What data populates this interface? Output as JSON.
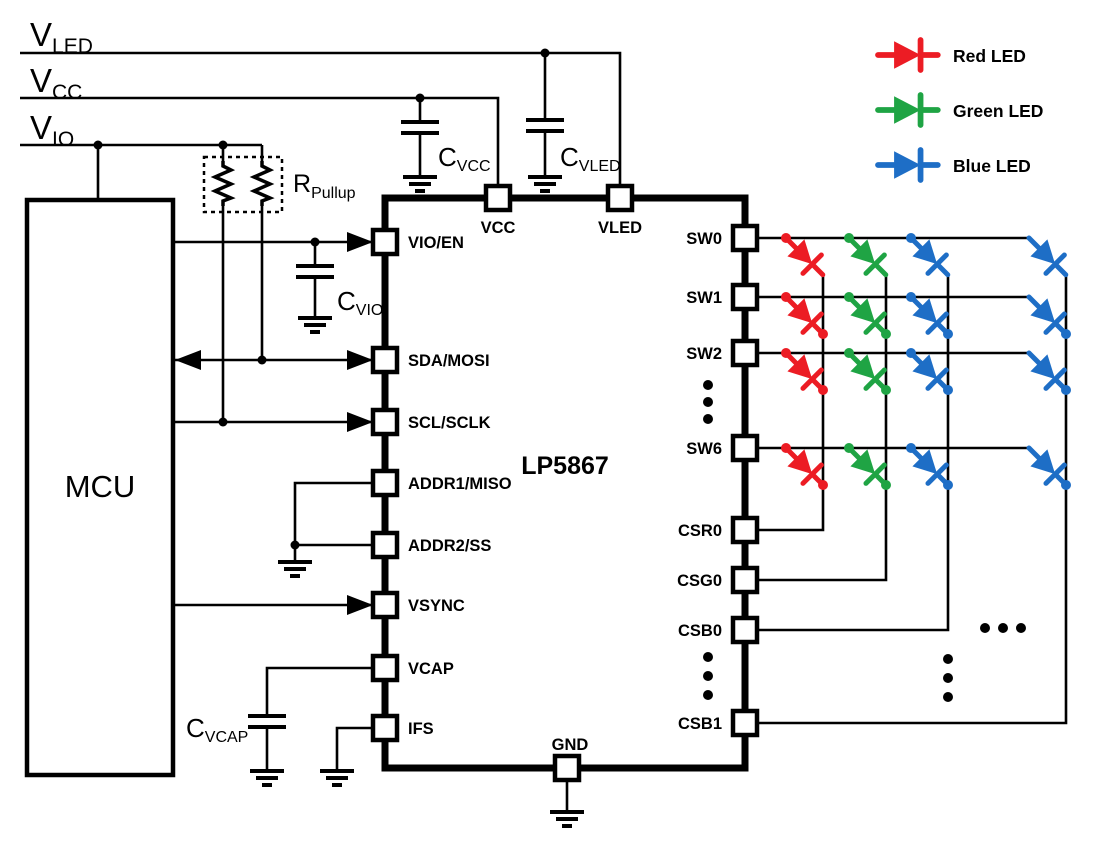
{
  "rails": {
    "vled": {
      "base": "V",
      "sub": "LED"
    },
    "vcc": {
      "base": "V",
      "sub": "CC"
    },
    "vio": {
      "base": "V",
      "sub": "IO"
    }
  },
  "mcu": {
    "label": "MCU"
  },
  "chip": {
    "name": "LP5867",
    "pins_left": [
      "VIO/EN",
      "SDA/MOSI",
      "SCL/SCLK",
      "ADDR1/MISO",
      "ADDR2/SS",
      "VSYNC",
      "VCAP",
      "IFS"
    ],
    "pins_top": [
      "VCC",
      "VLED"
    ],
    "pins_bottom": [
      "GND"
    ],
    "pins_right": [
      "SW0",
      "SW1",
      "SW2",
      "SW6",
      "CSR0",
      "CSG0",
      "CSB0",
      "CSB1"
    ]
  },
  "passives": {
    "r_pullup": {
      "base": "R",
      "sub": "Pullup"
    },
    "c_vio": {
      "base": "C",
      "sub": "VIO"
    },
    "c_vcc": {
      "base": "C",
      "sub": "VCC"
    },
    "c_vled": {
      "base": "C",
      "sub": "VLED"
    },
    "c_vcap": {
      "base": "C",
      "sub": "VCAP"
    }
  },
  "legend": {
    "items": [
      {
        "label": "Red LED",
        "color": "#ec1c24"
      },
      {
        "label": "Green LED",
        "color": "#1fa444"
      },
      {
        "label": "Blue LED",
        "color": "#1e6ec6"
      }
    ]
  }
}
